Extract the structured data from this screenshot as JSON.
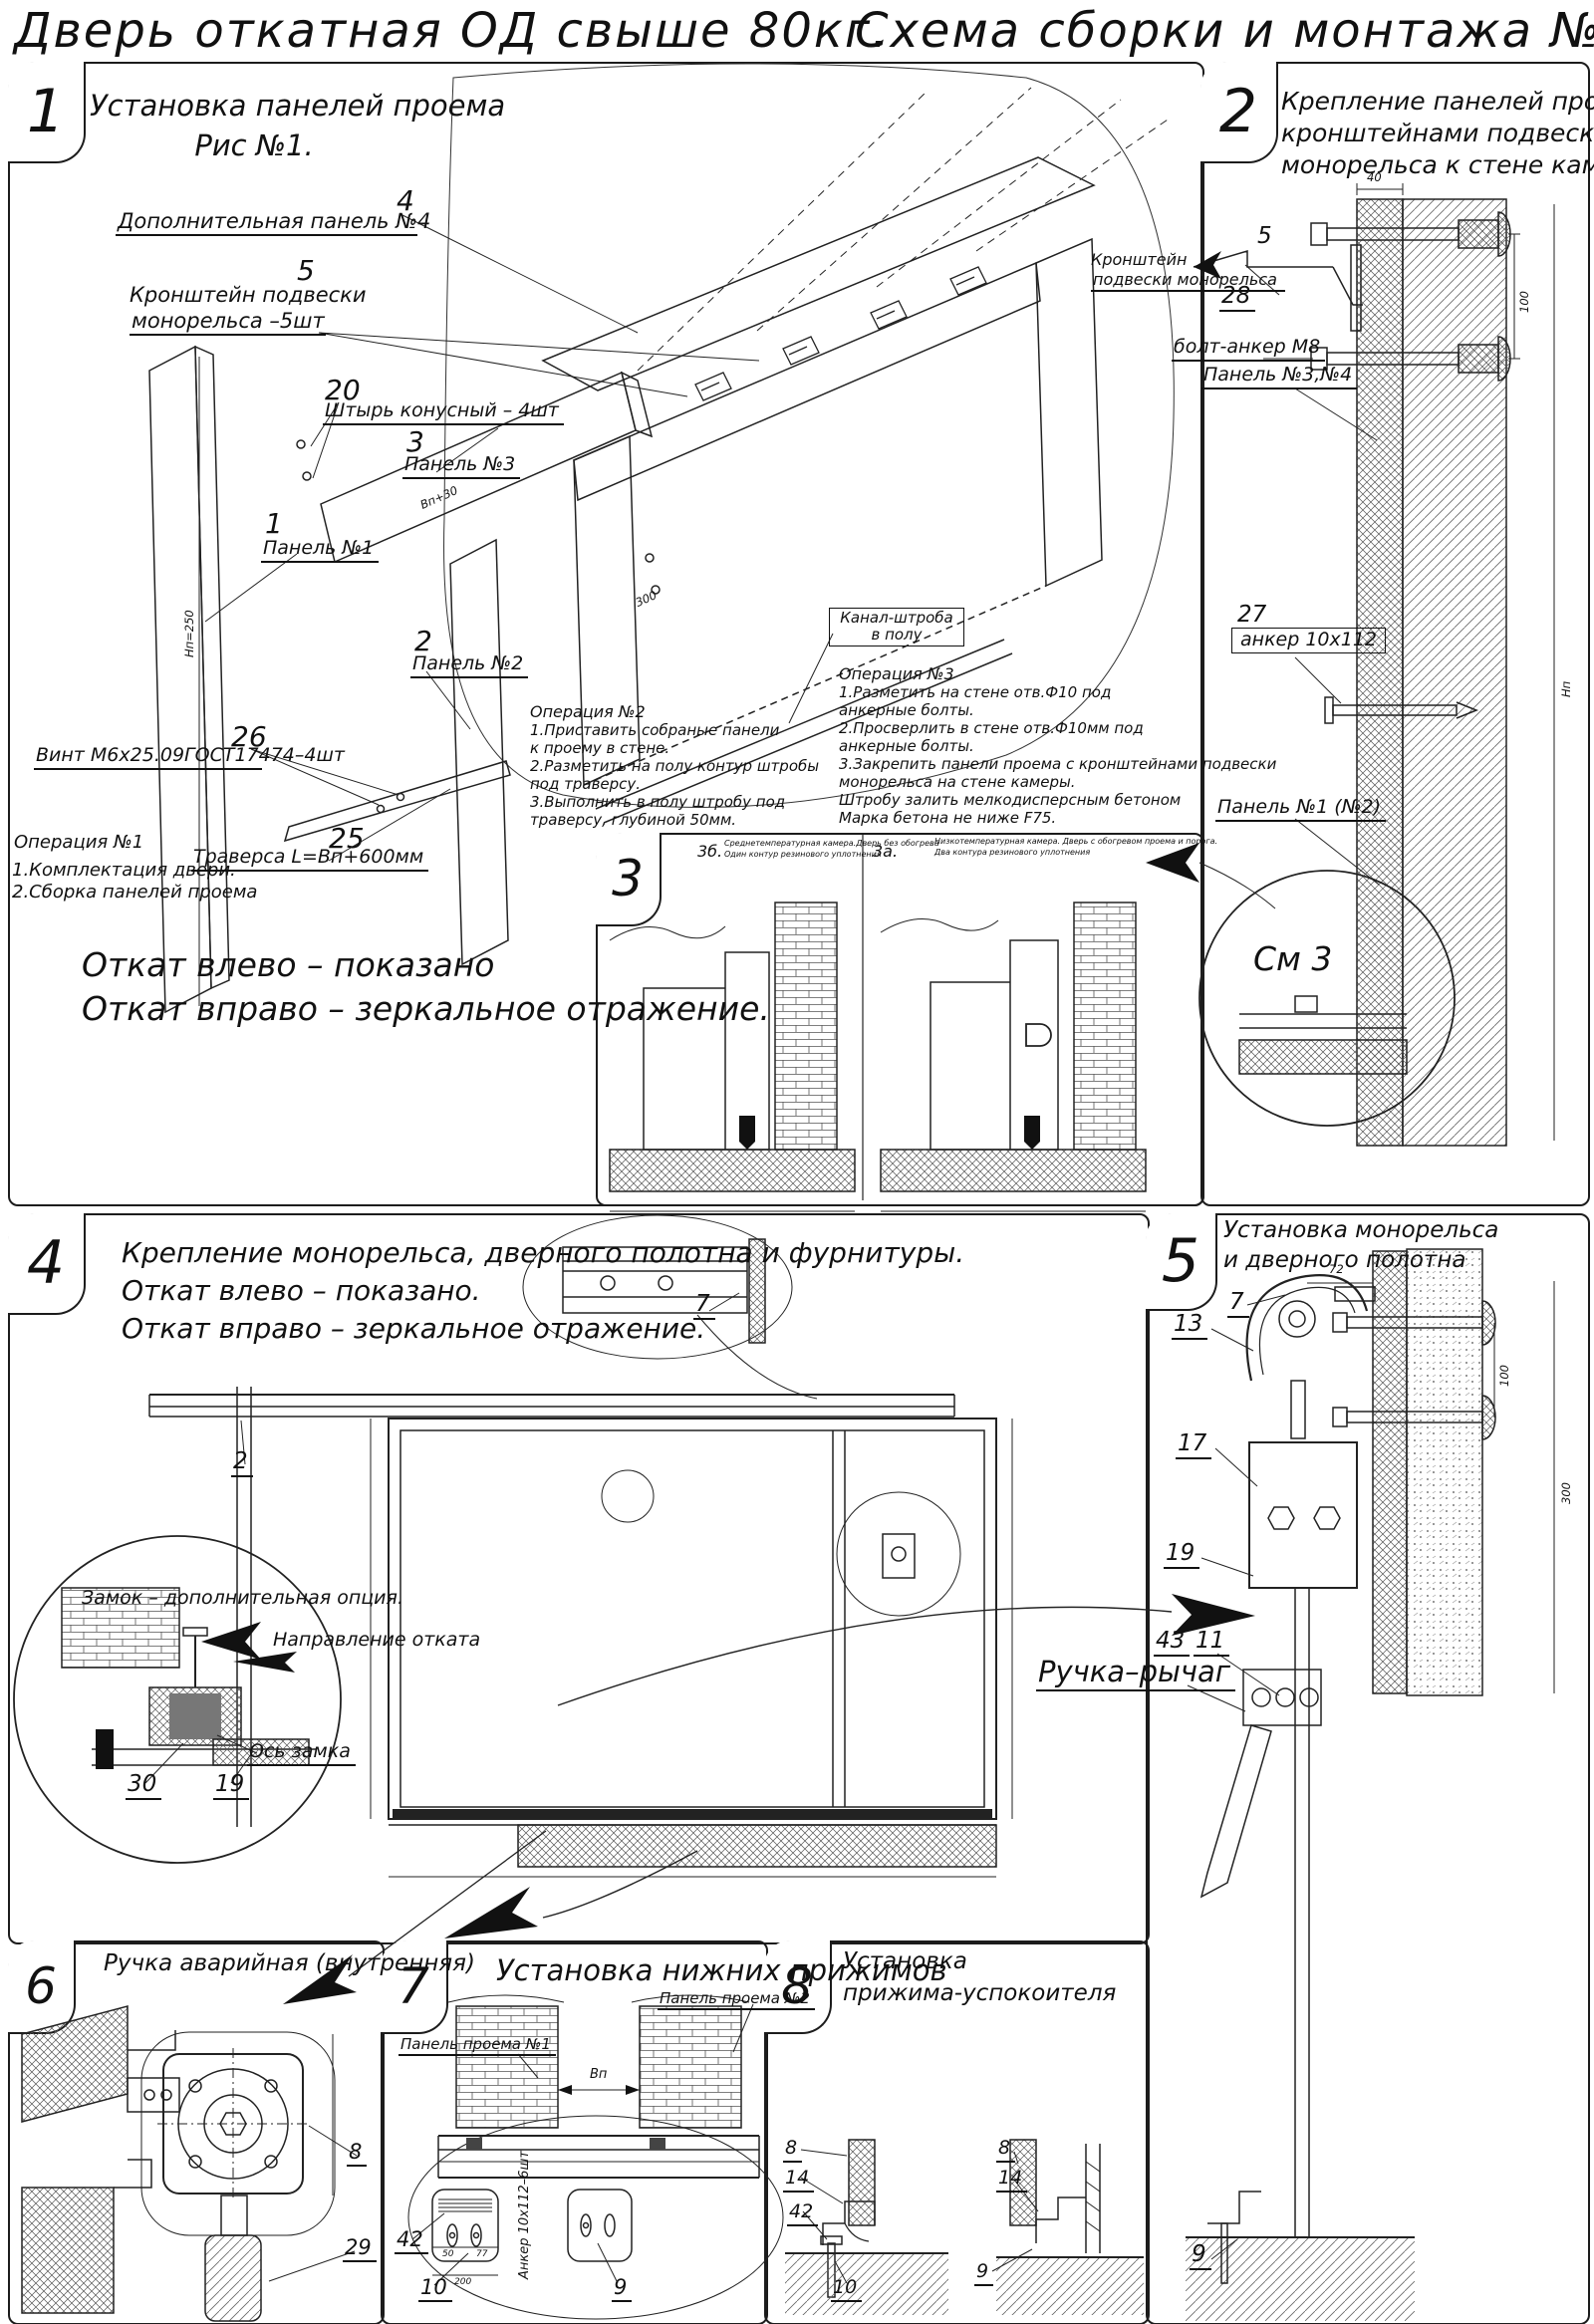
{
  "header": {
    "title_left": "Дверь откатная ОД свыше 80кг.",
    "title_right": "Схема сборки и монтажа №6"
  },
  "p1": {
    "num": "1",
    "title1": "Установка панелей проема",
    "title2": "Рис №1.",
    "c4n": "4",
    "c4": "Дополнительная панель №4",
    "c5n": "5",
    "c5a": "Кронштейн подвески",
    "c5b": "монорельса –5шт",
    "c20n": "20",
    "c20": "Штырь конусный – 4шт",
    "c3n": "3",
    "c3": "Панель №3",
    "c1n": "1",
    "c1": "Панель №1",
    "c2n": "2",
    "c2": "Панель №2",
    "c26n": "26",
    "c26": "Винт М6х25.09ГОСТ17474–4шт",
    "c25n": "25",
    "c25": "Траверса  L=Вп+600мм",
    "kanal1": "Канал-штроба",
    "kanal2": "в полу",
    "dimh": "Нп=250",
    "dimw": "Вп+30",
    "dim300": "300",
    "op1t": "Операция №1",
    "op1l1": "1.Комплектация двери.",
    "op1l2": "2.Сборка панелей проема",
    "op2t": "Операция №2",
    "op2l1": "1.Приставить собраные панели",
    "op2l2": "к проему в стене.",
    "op2l3": "2.Разметить на полу контур штробы",
    "op2l4": "под траверсу.",
    "op2l5": "3.Выполнить в полу штробу под",
    "op2l6": "траверсу, глубиной 50мм.",
    "op3t": "Операция №3",
    "op3l1": "1.Разметить на стене отв.Ф10 под",
    "op3l2": "анкерные болты.",
    "op3l3": "2.Просверлить в стене отв.Ф10мм  под",
    "op3l4": "анкерные болты.",
    "op3l5": "3.Закрепить панели проема с кронштейнами подвески",
    "op3l6": "монорельса на стене камеры.",
    "op3l7": "Штробу залить мелкодисперсным бетоном",
    "op3l8": "Марка бетона не ниже  F75.",
    "note1": "Откат влево – показано",
    "note2": "Откат вправо – зеркальное отражение."
  },
  "p2": {
    "num": "2",
    "title1": "Крепление панелей проема с",
    "title2": "кронштейнами подвески",
    "title3": "монорельса к стене камеры.",
    "c5n": "5",
    "c5a": "Кронштейн",
    "c5b": "подвески монорельса",
    "c28n": "28",
    "c28": "болт-анкер М8",
    "cp34": "Панель №3,№4",
    "c27n": "27",
    "c27": "анкер 10х112",
    "cp12": "Панель №1 (№2)",
    "see3": "См 3",
    "d40": "40",
    "d100": "100",
    "dnp": "Нп"
  },
  "p3": {
    "num": "3",
    "sb": "3б.",
    "sbl1": "Среднетемпературная камера.Дверь без обогрева",
    "sbl2": "Один контур резинового уплотнения",
    "sa": "3а.",
    "sal1": "Низкотемпературная камера. Дверь с обогревом проема и порога.",
    "sal2": "Два контура резинового уплотнения"
  },
  "p4": {
    "num": "4",
    "title1": "Крепление монорельса, дверного полотна и фурнитуры.",
    "title2": "Откат влево – показано.",
    "title3": "Откат вправо – зеркальное отражение.",
    "lock": "Замок – дополнительная опция.",
    "dir": "Направление отката",
    "axis": "Ось замка",
    "c30": "30",
    "c19": "19",
    "c7": "7",
    "c2": "2"
  },
  "p5": {
    "num": "5",
    "title1": "Установка монорельса",
    "title2": "и дверного полотна",
    "c7": "7",
    "c13": "13",
    "c17": "17",
    "c19": "19",
    "c43": "43",
    "c11": "11",
    "c9": "9",
    "handle": "Ручка–рычаг",
    "d72": "72",
    "d100": "100",
    "d300": "300"
  },
  "p6": {
    "num": "6",
    "title": "Ручка аварийная (внутренняя)",
    "c8": "8",
    "c29": "29"
  },
  "p7": {
    "num": "7",
    "title": "Установка  нижних  прижимов",
    "pp1": "Панель проема №1",
    "pp2": "Панель проема №2",
    "anchor": "Анкер  10х112–6шт",
    "c42": "42",
    "c10": "10",
    "c9": "9",
    "dvp": "Вп",
    "d50": "50",
    "d77": "77",
    "d200": "200"
  },
  "p8": {
    "num": "8",
    "title1": "Установка",
    "title2": "прижима-успокоителя",
    "c8a": "8",
    "c14a": "14",
    "c42": "42",
    "c10": "10",
    "c8b": "8",
    "c14b": "14",
    "c9": "9"
  }
}
